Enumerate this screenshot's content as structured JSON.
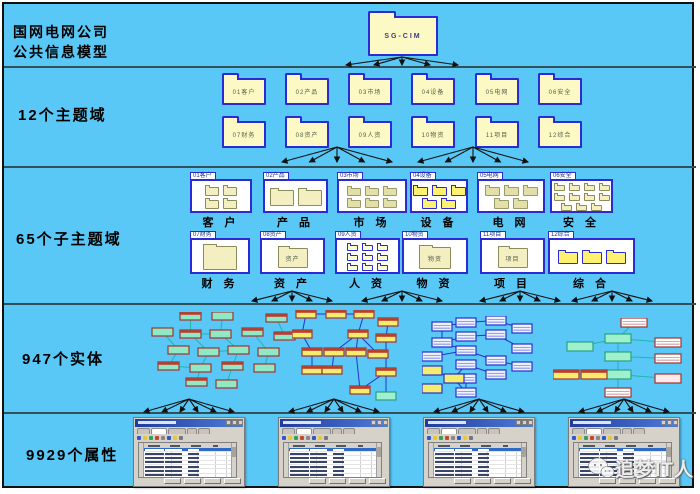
{
  "header": {
    "title_line1": "国网电网公司",
    "title_line2": "公共信息模型"
  },
  "levels": {
    "subjects": "12个主题域",
    "subdomains": "65个子主题域",
    "entities": "947个实体",
    "attributes": "9929个属性"
  },
  "root_folder_label": "SG-CIM",
  "subject_domains": [
    "01客户",
    "02产品",
    "03市场",
    "04设备",
    "05电网",
    "06安全",
    "07财务",
    "08资产",
    "09人资",
    "10物资",
    "11项目",
    "12综合"
  ],
  "sub_domains": [
    {
      "tab": "01客户",
      "caption": "客 户",
      "folder_label": ""
    },
    {
      "tab": "02产品",
      "caption": "产 品",
      "folder_label": ""
    },
    {
      "tab": "03市场",
      "caption": "市 场",
      "folder_label": ""
    },
    {
      "tab": "04设备",
      "caption": "设 备",
      "folder_label": ""
    },
    {
      "tab": "05电网",
      "caption": "电 网",
      "folder_label": ""
    },
    {
      "tab": "06安全",
      "caption": "安 全",
      "folder_label": ""
    },
    {
      "tab": "07财务",
      "caption": "财 务",
      "folder_label": ""
    },
    {
      "tab": "08资产",
      "caption": "资 产",
      "folder_label": "资产"
    },
    {
      "tab": "09人资",
      "caption": "人 资",
      "folder_label": ""
    },
    {
      "tab": "10物资",
      "caption": "物 资",
      "folder_label": "物资"
    },
    {
      "tab": "11项目",
      "caption": "项 目",
      "folder_label": "项目"
    },
    {
      "tab": "12综合",
      "caption": "综 合",
      "folder_label": ""
    }
  ],
  "watermark_text": "追梦IT人",
  "colors": {
    "background": "#5AC8F7",
    "band_line": "#334F58",
    "folder_fill": "#FCF9C4",
    "folder_border": "#2B2BD5",
    "arrow": "#111111",
    "window_title": "#1E3C9E",
    "highlight_row": "#316AC5"
  },
  "box_styles": {
    "g": {
      "fill": "#8FE9C4",
      "stroke": "#A23430"
    },
    "gh": {
      "fill": "#8FE9C4",
      "stroke": "#A23430",
      "header": "#C0392B"
    },
    "g2": {
      "fill": "#9FF0CC",
      "stroke": "#2AA080"
    },
    "y": {
      "fill": "#F6EC6E",
      "stroke": "#A23430",
      "header": "#C0392B"
    },
    "yh": {
      "fill": "#F6EC6E",
      "stroke": "#A23430",
      "header": "#C0392B"
    },
    "ys": {
      "fill": "#F6EC6E",
      "stroke": "#2233CC"
    },
    "s": {
      "fill": "#EEF2FF",
      "stroke": "#2233CC",
      "striped": true
    },
    "rs": {
      "fill": "#FFFFFF",
      "stroke": "#A23430",
      "striped": true
    },
    "r": {
      "fill": "#FDEAEA",
      "stroke": "#A23430"
    }
  },
  "entity_clusters": [
    {
      "x": 150,
      "y": 312,
      "w": 150,
      "h": 90,
      "bw": 21,
      "bh": 8,
      "line": "#1FB6A8",
      "boxes": [
        [
          30,
          0,
          "gh"
        ],
        [
          62,
          0,
          "g"
        ],
        [
          116,
          2,
          "gh"
        ],
        [
          2,
          16,
          "g"
        ],
        [
          30,
          18,
          "gh"
        ],
        [
          60,
          18,
          "g"
        ],
        [
          92,
          16,
          "gh"
        ],
        [
          124,
          20,
          "gh"
        ],
        [
          18,
          34,
          "g"
        ],
        [
          48,
          36,
          "g"
        ],
        [
          78,
          34,
          "g"
        ],
        [
          108,
          36,
          "g"
        ],
        [
          8,
          50,
          "gh"
        ],
        [
          40,
          52,
          "g"
        ],
        [
          72,
          50,
          "gh"
        ],
        [
          104,
          52,
          "g"
        ],
        [
          36,
          66,
          "gh"
        ],
        [
          66,
          68,
          "g"
        ]
      ],
      "links": [
        [
          0,
          4
        ],
        [
          1,
          5
        ],
        [
          2,
          7
        ],
        [
          3,
          8
        ],
        [
          4,
          9
        ],
        [
          5,
          10
        ],
        [
          6,
          11
        ],
        [
          4,
          5
        ],
        [
          8,
          12
        ],
        [
          9,
          13
        ],
        [
          10,
          14
        ],
        [
          11,
          15
        ],
        [
          13,
          16
        ],
        [
          14,
          17
        ],
        [
          9,
          10
        ],
        [
          12,
          13
        ]
      ]
    },
    {
      "x": 292,
      "y": 310,
      "w": 108,
      "h": 92,
      "bw": 20,
      "bh": 8,
      "line": "#2233CC",
      "boxes": [
        [
          4,
          0,
          "y"
        ],
        [
          34,
          0,
          "y"
        ],
        [
          62,
          0,
          "y"
        ],
        [
          86,
          8,
          "y"
        ],
        [
          0,
          20,
          "y"
        ],
        [
          56,
          20,
          "y"
        ],
        [
          84,
          24,
          "y"
        ],
        [
          10,
          38,
          "y"
        ],
        [
          32,
          38,
          "y"
        ],
        [
          54,
          38,
          "y"
        ],
        [
          76,
          40,
          "y"
        ],
        [
          10,
          56,
          "y"
        ],
        [
          30,
          56,
          "y"
        ],
        [
          84,
          58,
          "y"
        ],
        [
          58,
          76,
          "y"
        ],
        [
          84,
          82,
          "g2"
        ]
      ],
      "links": [
        [
          0,
          1
        ],
        [
          1,
          2
        ],
        [
          2,
          5
        ],
        [
          3,
          6
        ],
        [
          0,
          4
        ],
        [
          4,
          7
        ],
        [
          5,
          9
        ],
        [
          5,
          8
        ],
        [
          5,
          10
        ],
        [
          6,
          13
        ],
        [
          7,
          11
        ],
        [
          8,
          12
        ],
        [
          13,
          14
        ],
        [
          13,
          15
        ],
        [
          9,
          14
        ]
      ]
    },
    {
      "x": 422,
      "y": 316,
      "w": 118,
      "h": 86,
      "bw": 20,
      "bh": 9,
      "line": "#2233CC",
      "boxes": [
        [
          10,
          6,
          "s"
        ],
        [
          10,
          22,
          "s"
        ],
        [
          0,
          36,
          "s"
        ],
        [
          34,
          2,
          "s"
        ],
        [
          34,
          16,
          "s"
        ],
        [
          34,
          30,
          "s"
        ],
        [
          34,
          44,
          "s"
        ],
        [
          34,
          58,
          "s"
        ],
        [
          64,
          0,
          "s"
        ],
        [
          64,
          14,
          "s"
        ],
        [
          64,
          40,
          "s"
        ],
        [
          64,
          54,
          "s"
        ],
        [
          90,
          8,
          "s"
        ],
        [
          90,
          28,
          "s"
        ],
        [
          90,
          46,
          "s"
        ],
        [
          0,
          50,
          "ys"
        ],
        [
          22,
          58,
          "ys"
        ],
        [
          0,
          68,
          "ys"
        ],
        [
          34,
          72,
          "s"
        ]
      ],
      "links": [
        [
          0,
          3
        ],
        [
          0,
          1
        ],
        [
          1,
          4
        ],
        [
          2,
          5
        ],
        [
          3,
          8
        ],
        [
          4,
          9
        ],
        [
          5,
          10
        ],
        [
          6,
          11
        ],
        [
          8,
          12
        ],
        [
          9,
          13
        ],
        [
          10,
          14
        ],
        [
          6,
          16
        ],
        [
          15,
          16
        ],
        [
          16,
          18
        ],
        [
          7,
          18
        ],
        [
          1,
          5
        ]
      ]
    },
    {
      "x": 553,
      "y": 318,
      "w": 145,
      "h": 88,
      "bw": 26,
      "bh": 9,
      "line": "#1FB6A8",
      "boxes": [
        [
          68,
          0,
          "rs"
        ],
        [
          52,
          16,
          "g2"
        ],
        [
          14,
          24,
          "g2"
        ],
        [
          52,
          34,
          "g2"
        ],
        [
          102,
          20,
          "rs"
        ],
        [
          102,
          36,
          "rs"
        ],
        [
          52,
          52,
          "g2"
        ],
        [
          0,
          52,
          "yh"
        ],
        [
          28,
          52,
          "yh"
        ],
        [
          102,
          56,
          "r"
        ],
        [
          52,
          70,
          "rs"
        ]
      ],
      "links": [
        [
          0,
          1
        ],
        [
          1,
          2
        ],
        [
          1,
          3
        ],
        [
          3,
          5
        ],
        [
          1,
          4
        ],
        [
          3,
          6
        ],
        [
          6,
          8
        ],
        [
          7,
          8
        ],
        [
          6,
          9
        ],
        [
          6,
          10
        ]
      ]
    }
  ]
}
